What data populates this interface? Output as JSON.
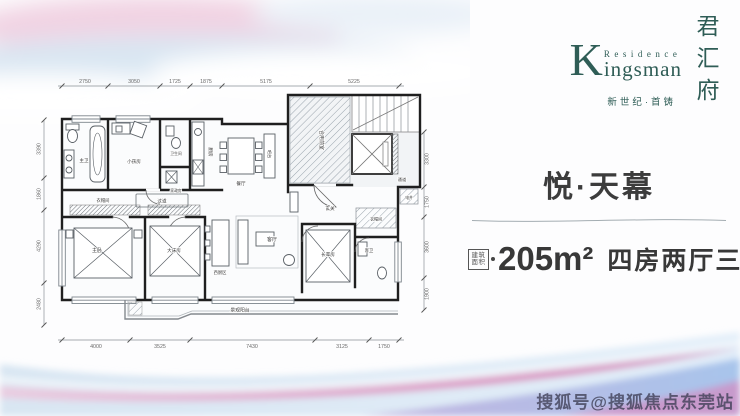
{
  "brand": {
    "k_initial": "K",
    "residence": "Residence",
    "kingsman_rest": "ingsman",
    "chinese_name": "君汇府",
    "tagline": "新世纪·首铸",
    "color": "#2f5d56"
  },
  "unit": {
    "name": "悦·天幕",
    "area_badge_line1": "建筑",
    "area_badge_line2": "面积",
    "area": "205m²",
    "rooms_desc": "四房两厅三卫"
  },
  "watermark": "搜狐号@搜狐焦点东莞站",
  "floorplan": {
    "rooms": {
      "master_bath": "主卫",
      "kids_room": "小孩房",
      "bathroom": "卫生间",
      "utility_room": "家政房",
      "kitchen": "厨房",
      "dining": "餐厅",
      "bar": "吧台",
      "vestibule": "合用前室",
      "passage": "通道",
      "shaft": "电井",
      "foyer": "玄关",
      "closet_a": "衣帽间",
      "hallway": "过道",
      "closet_b": "衣帽间",
      "master_bedroom": "主卧",
      "second_bedroom": "大床房",
      "living": "客厅",
      "west_kitchen": "西厨区",
      "guest_bath": "客卫",
      "elder_room": "长辈房",
      "balcony": "景观阳台"
    },
    "dims_top": [
      "2750",
      "3050",
      "1725",
      "1875",
      "5175",
      "5225"
    ],
    "dims_bottom": [
      "4000",
      "3525",
      "7430",
      "3125",
      "1750"
    ],
    "dims_left": [
      "3390",
      "1860",
      "4290",
      "2480"
    ],
    "dims_right": [
      "3300",
      "1750",
      "3600",
      "1900"
    ]
  }
}
